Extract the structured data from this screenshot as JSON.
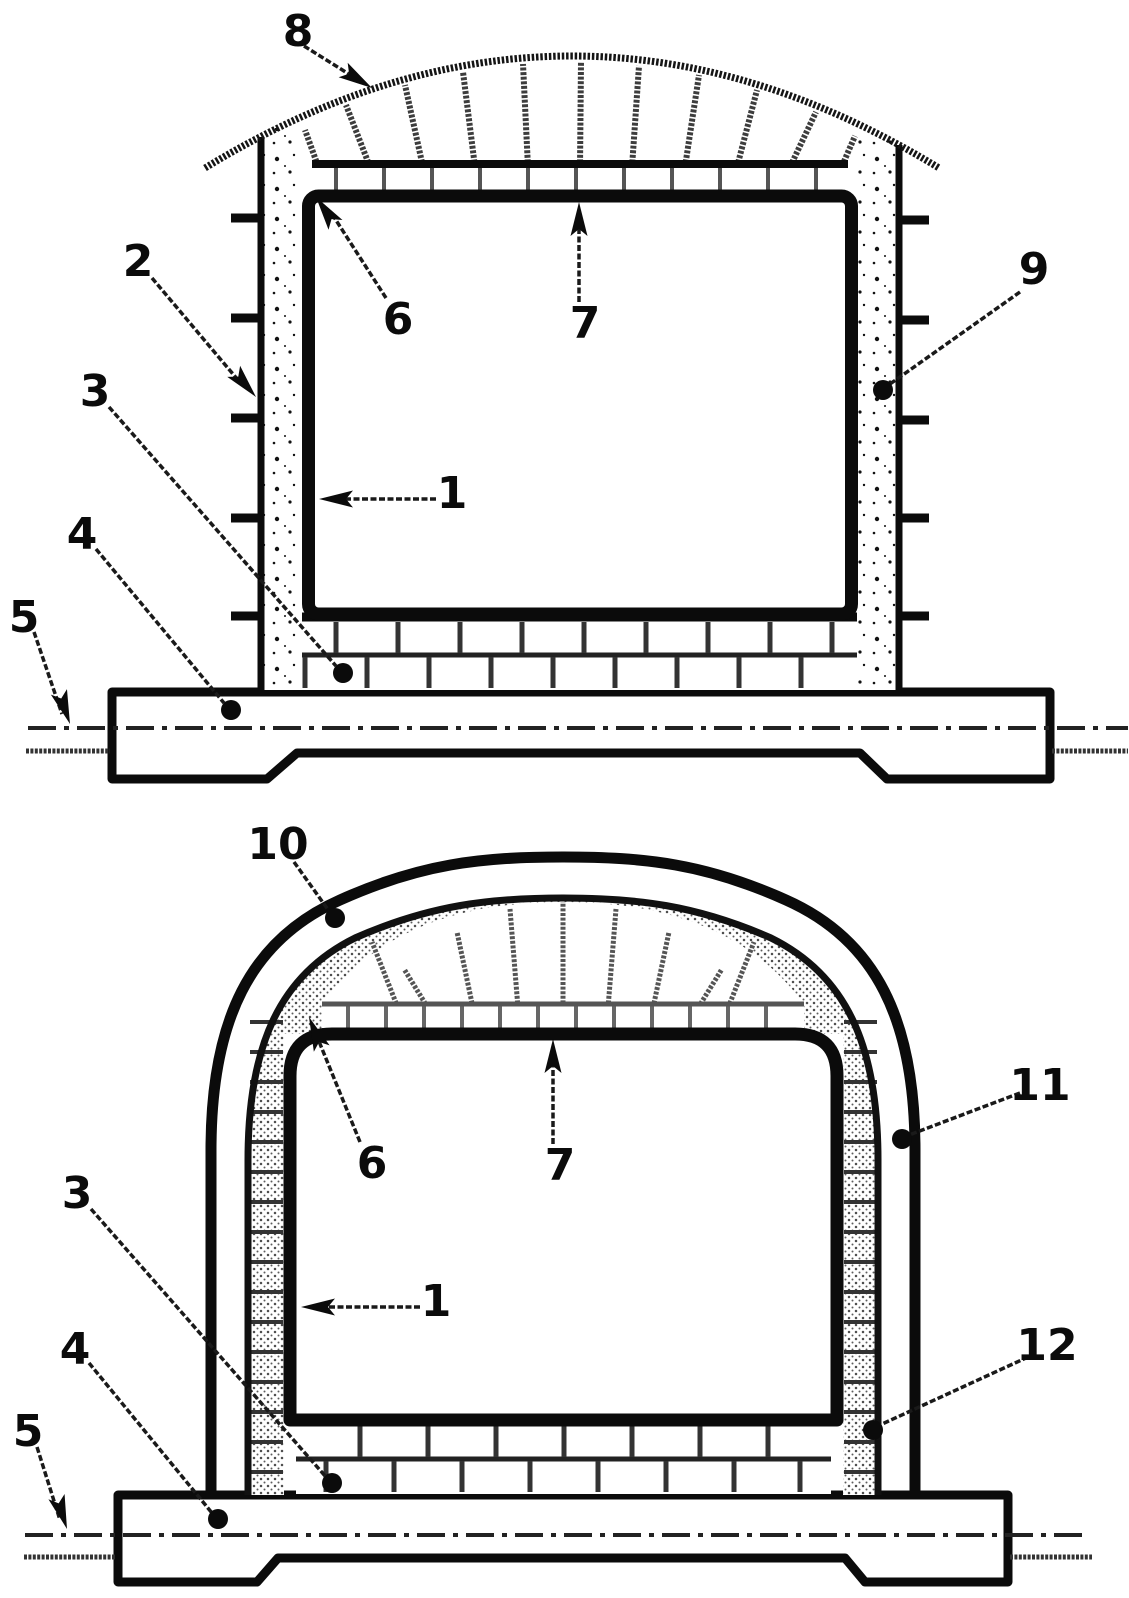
{
  "page": {
    "background_color": "#ffffff",
    "ink_color": "#0b0b0b",
    "figure_count": 2
  },
  "figure_top": {
    "labels": {
      "n1": "1",
      "n2": "2",
      "n3": "3",
      "n4": "4",
      "n5": "5",
      "n6": "6",
      "n7": "7",
      "n8": "8",
      "n9": "9"
    }
  },
  "figure_bottom": {
    "labels": {
      "n1": "1",
      "n3": "3",
      "n4": "4",
      "n5": "5",
      "n6": "6",
      "n7": "7",
      "n10": "10",
      "n11": "11",
      "n12": "12"
    }
  }
}
